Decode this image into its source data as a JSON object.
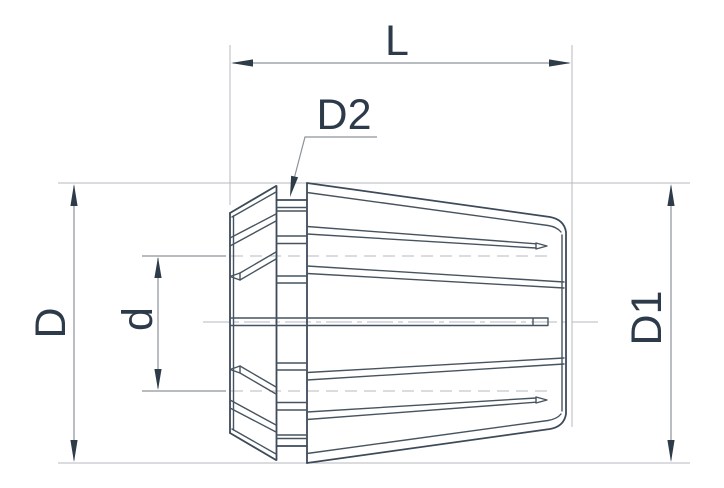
{
  "drawing": {
    "title": "collet-technical-drawing",
    "labels": {
      "L": "L",
      "D2": "D2",
      "D": "D",
      "d": "d",
      "D1": "D1"
    },
    "colors": {
      "background": "#ffffff",
      "outline": "#3d4a59",
      "detail": "#47545f",
      "dimension_line": "#8d939b",
      "extension_line": "#b6bac0",
      "arrow": "#2e3b49",
      "text": "#2d3a49"
    }
  }
}
